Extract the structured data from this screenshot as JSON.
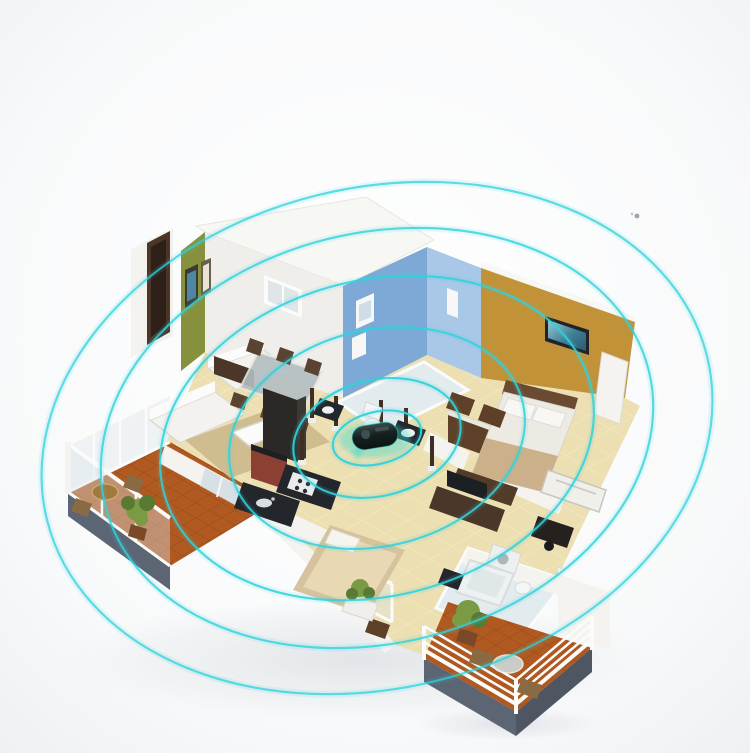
{
  "illustration": {
    "kind": "isometric-floorplan-with-signal-rings",
    "canvas": {
      "width": 750,
      "height": 753
    }
  },
  "palette": {
    "bg_center": "#fdfdfd",
    "bg_edge": "#f1f2f4",
    "ring": "#2fd2dc",
    "roof_white": "#f7f7f3",
    "wall_white": "#efeeea",
    "wall_white_bright": "#f4f3ef",
    "wall_shadow": "#d9d7d1",
    "olive": "#87913d",
    "blue_dark": "#7ea8d6",
    "blue_light": "#a9c7e6",
    "mustard": "#c29238",
    "floor": "#ecdfb2",
    "bath_floor": "#e2ebee",
    "terracotta": "#b05920",
    "base_slate": "#5c6573",
    "base_slate_dark": "#4e5662",
    "wood_dark": "#4a3728",
    "wood_mid": "#5d4027",
    "wood_light": "#8a6a42",
    "red_cabinet": "#8c4034",
    "counter_black": "#23262b",
    "mattress": "#eceae2",
    "bed_beige": "#d6c29c",
    "rug": "#cdbb8e",
    "glass": "#cddbe2",
    "plant": "#7a9a44",
    "plant_dark": "#5a7a33",
    "device_body": "#182422",
    "device_glow": "#35d8d2",
    "shadow": "#d6dade",
    "speck": "#8e9499"
  },
  "rings": {
    "center": {
      "x": 377,
      "y": 438
    },
    "rotation_deg": -14,
    "stroke_width": 2.2,
    "glow_width": 7,
    "ellipses": [
      {
        "rx": 45,
        "ry": 26,
        "opacity": 0.95
      },
      {
        "rx": 85,
        "ry": 58,
        "opacity": 0.9
      },
      {
        "rx": 150,
        "ry": 108,
        "opacity": 0.85
      },
      {
        "rx": 220,
        "ry": 158,
        "opacity": 0.85
      },
      {
        "rx": 280,
        "ry": 205,
        "opacity": 0.8
      },
      {
        "rx": 340,
        "ry": 250,
        "opacity": 0.75
      }
    ]
  },
  "device": {
    "x": 375,
    "y": 436,
    "width": 46,
    "height": 24,
    "rotation_deg": -9
  },
  "speck": {
    "x": 637,
    "y": 216
  }
}
